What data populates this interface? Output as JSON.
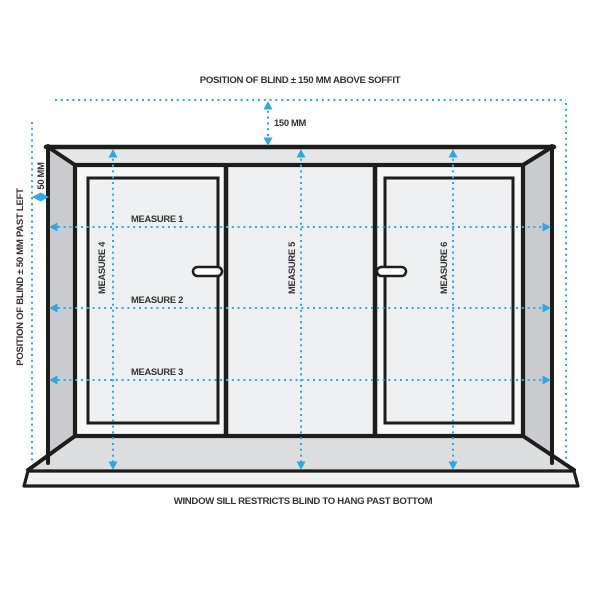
{
  "diagram": {
    "type": "window-blind-measuring-guide",
    "annotations": {
      "top_title": "POSITION OF BLIND ± 150 MM ABOVE SOFFIT",
      "left_title": "POSITION OF BLIND ± 50 MM PAST LEFT",
      "bottom_title": "WINDOW SILL RESTRICTS BLIND TO HANG PAST BOTTOM",
      "top_offset_label": "150 MM",
      "left_offset_label": "50 MM"
    },
    "measures": {
      "width_lines": [
        {
          "label": "MEASURE 1"
        },
        {
          "label": "MEASURE 2"
        },
        {
          "label": "MEASURE 3"
        }
      ],
      "drop_lines": [
        {
          "label": "MEASURE 4"
        },
        {
          "label": "MEASURE 5"
        },
        {
          "label": "MEASURE 6"
        }
      ]
    },
    "colors": {
      "accent_blue": "#29ABE2",
      "outline_black": "#1D1D1B",
      "text": "#333333",
      "frame_top_face": "#e6e7e9",
      "frame_side_face": "#c9cbce",
      "sill_top_face": "#dcddde",
      "recess_face": "#f6f7f7",
      "panel_fill": "#eff0f1",
      "background": "#ffffff"
    }
  }
}
